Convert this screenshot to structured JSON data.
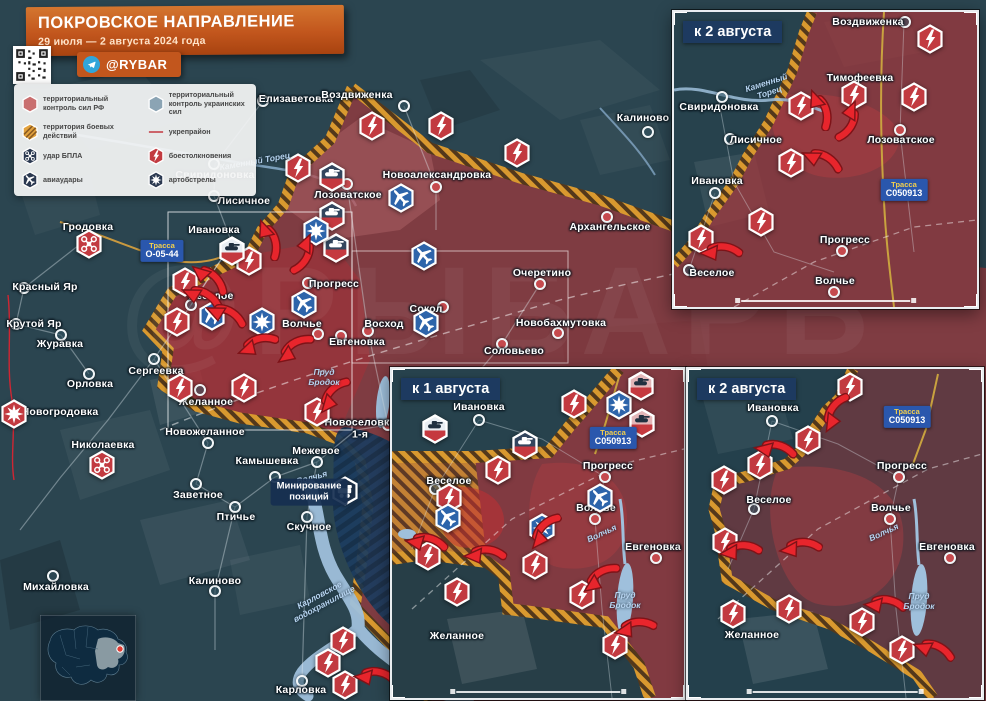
{
  "header": {
    "title": "ПОКРОВСКОЕ НАПРАВЛЕНИЕ",
    "date_range": "29 июля — 2 августа 2024 года",
    "channel": "@RYBAR"
  },
  "colors": {
    "rf_control": "#b24a4e",
    "ua_control": "#8ba4b4",
    "combat_zone": "#d9992f",
    "fortified_line": "#c0222c",
    "accent_orange": "#c2561d",
    "inset_header_bg": "#1d3a60",
    "road_label_bg": "#2a57ad",
    "water": "#9fc0dc"
  },
  "legend": {
    "items": [
      {
        "icon": "rf-control",
        "label": "территориальный контроль сил РФ"
      },
      {
        "icon": "ua-control",
        "label": "территориальный контроль украинских сил"
      },
      {
        "icon": "combat-zone",
        "label": "территория боевых действий"
      },
      {
        "icon": "fortline",
        "label": "укрепрайон"
      },
      {
        "icon": "drone-dark",
        "label": "удар БПЛА"
      },
      {
        "icon": "clash",
        "label": "боестолкновения"
      },
      {
        "icon": "airstrike-dark",
        "label": "авиаудары"
      },
      {
        "icon": "artillery-dark",
        "label": "артобстрелы"
      }
    ]
  },
  "main_map": {
    "towns": [
      [
        "Елизаветовка",
        296,
        100,
        263,
        101,
        "ua"
      ],
      [
        "Воздвиженка",
        357,
        96,
        404,
        106,
        "ua"
      ],
      [
        "Калиново",
        643,
        119,
        648,
        132,
        "ua"
      ],
      [
        "Свиридоновка",
        215,
        176,
        214,
        164,
        "ua"
      ],
      [
        "Лисичное",
        244,
        202,
        214,
        196,
        "ua"
      ],
      [
        "Лозоватское",
        348,
        196,
        347,
        184,
        "rf"
      ],
      [
        "Новоалександровка",
        437,
        176,
        436,
        187,
        "rf"
      ],
      [
        "Архангельское",
        610,
        228,
        607,
        217,
        "rf"
      ],
      [
        "Ивановка",
        214,
        231,
        232,
        243,
        "ua"
      ],
      [
        "Очеретино",
        542,
        274,
        540,
        284,
        "rf"
      ],
      [
        "Веселое",
        211,
        297,
        191,
        305,
        "ua"
      ],
      [
        "Прогресс",
        334,
        285,
        308,
        283,
        "rf"
      ],
      [
        "Волчье",
        302,
        325,
        318,
        334,
        "rf"
      ],
      [
        "Восход",
        384,
        325,
        368,
        331,
        "rf"
      ],
      [
        "Сокол",
        426,
        310,
        443,
        307,
        "rf"
      ],
      [
        "Евгеновка",
        357,
        343,
        341,
        336,
        "rf"
      ],
      [
        "Новобахмутовка",
        561,
        324,
        558,
        333,
        "rf"
      ],
      [
        "Соловьево",
        514,
        352,
        502,
        344,
        "rf"
      ],
      [
        "Сергеевка",
        156,
        372,
        154,
        359,
        "ua"
      ],
      [
        "Желанное",
        206,
        403,
        200,
        390,
        "ua"
      ],
      [
        "Новоселовка\n1-я",
        360,
        429,
        388,
        425,
        "rf"
      ],
      [
        "Гродовка",
        88,
        228,
        null,
        null,
        "ua"
      ],
      [
        "Красный Яр",
        45,
        288,
        24,
        288,
        "ua"
      ],
      [
        "Крутой Яр",
        34,
        325,
        16,
        324,
        "ua"
      ],
      [
        "Журавка",
        60,
        345,
        61,
        335,
        "ua"
      ],
      [
        "Орловка",
        90,
        385,
        89,
        374,
        "ua"
      ],
      [
        "Новогродовка",
        60,
        413,
        null,
        null,
        "ua"
      ],
      [
        "Николаевка",
        103,
        446,
        null,
        null,
        "ua"
      ],
      [
        "Новожеланное",
        205,
        433,
        208,
        443,
        "ua"
      ],
      [
        "Камышевка",
        267,
        462,
        275,
        477,
        "ua"
      ],
      [
        "Межевое",
        316,
        452,
        317,
        462,
        "ua"
      ],
      [
        "Заветное",
        198,
        496,
        196,
        484,
        "ua"
      ],
      [
        "Птичье",
        236,
        518,
        235,
        507,
        "ua"
      ],
      [
        "Скучное",
        309,
        528,
        307,
        517,
        "ua"
      ],
      [
        "Калиново",
        215,
        582,
        215,
        591,
        "ua"
      ],
      [
        "Михайловка",
        56,
        588,
        53,
        576,
        "ua"
      ],
      [
        "Карловка",
        301,
        691,
        302,
        681,
        "ua"
      ]
    ],
    "icons": [
      [
        "clash",
        372,
        126
      ],
      [
        "clash",
        441,
        126
      ],
      [
        "clash",
        517,
        153
      ],
      [
        "clash",
        298,
        168
      ],
      [
        "clash",
        249,
        261
      ],
      [
        "clash",
        185,
        282
      ],
      [
        "clash",
        177,
        322
      ],
      [
        "clash",
        180,
        388
      ],
      [
        "clash",
        244,
        388
      ],
      [
        "clash",
        317,
        412
      ],
      [
        "clash",
        343,
        641
      ],
      [
        "clash",
        328,
        663
      ],
      [
        "clash",
        345,
        685
      ],
      [
        "tank-dark",
        332,
        177
      ],
      [
        "tank-dark",
        332,
        216
      ],
      [
        "tank-dark",
        336,
        248
      ],
      [
        "tank-white",
        232,
        251
      ],
      [
        "airstrike",
        401,
        198
      ],
      [
        "airstrike",
        424,
        256
      ],
      [
        "airstrike",
        426,
        323
      ],
      [
        "airstrike",
        304,
        304
      ],
      [
        "airstrike",
        212,
        316
      ],
      [
        "artillery-blue",
        316,
        231
      ],
      [
        "artillery-blue",
        262,
        322
      ],
      [
        "drone-red",
        89,
        244
      ],
      [
        "drone-red",
        102,
        465
      ],
      [
        "artillery-red",
        14,
        414
      ],
      [
        "mine",
        345,
        491
      ]
    ],
    "arrows": [
      [
        266,
        240,
        90
      ],
      [
        300,
        252,
        135
      ],
      [
        207,
        281,
        60
      ],
      [
        200,
        300,
        45
      ],
      [
        224,
        318,
        45
      ],
      [
        258,
        348,
        0
      ],
      [
        296,
        352,
        -15
      ],
      [
        336,
        398,
        -30
      ],
      [
        374,
        680,
        25
      ]
    ],
    "road_labels": [
      [
        "Трасса",
        "О-05-44",
        162,
        251
      ]
    ],
    "water_labels": [
      [
        "Каменный Торец",
        255,
        162,
        -10
      ],
      [
        "Пруд\nБродок",
        324,
        378,
        0
      ],
      [
        "Карловское\nводохранилище",
        322,
        600,
        -28
      ],
      [
        "Волчья",
        312,
        478,
        -15
      ]
    ],
    "notes": [
      {
        "text": "Минирование\nпозиций",
        "x": 309,
        "y": 492
      }
    ]
  },
  "insets": [
    {
      "label": "к 2 августа",
      "towns": [
        [
          "Воздвиженка",
          194,
          11,
          231,
          10,
          "ua"
        ],
        [
          "Тимофеевка",
          186,
          67,
          null,
          null,
          "rf"
        ],
        [
          "Свиридоновка",
          45,
          96,
          48,
          85,
          "ua"
        ],
        [
          "Лисичное",
          82,
          129,
          56,
          127,
          "ua"
        ],
        [
          "Лозоватское",
          227,
          129,
          226,
          118,
          "rf"
        ],
        [
          "Ивановка",
          43,
          170,
          41,
          181,
          "ua"
        ],
        [
          "Веселое",
          38,
          262,
          15,
          258,
          "ua"
        ],
        [
          "Прогресс",
          171,
          229,
          168,
          239,
          "rf"
        ],
        [
          "Волчье",
          161,
          270,
          160,
          280,
          "rf"
        ]
      ],
      "icons": [
        [
          "clash",
          256,
          27
        ],
        [
          "clash",
          127,
          94
        ],
        [
          "clash",
          180,
          83
        ],
        [
          "clash",
          240,
          85
        ],
        [
          "clash",
          117,
          151
        ],
        [
          "clash",
          87,
          210
        ],
        [
          "clash",
          27,
          227
        ]
      ],
      "arrows": [
        [
          143,
          98,
          90
        ],
        [
          171,
          107,
          135
        ],
        [
          146,
          151,
          45
        ],
        [
          46,
          243,
          20
        ]
      ],
      "road_labels": [
        [
          "Трасса",
          "C050913",
          230,
          178
        ]
      ],
      "water_labels": [
        [
          "Каменный\nТорец",
          94,
          76,
          -18
        ]
      ]
    },
    {
      "label": "к 1 августа",
      "towns": [
        [
          "Ивановка",
          87,
          39,
          87,
          51,
          "ua"
        ],
        [
          "Веселое",
          57,
          113,
          43,
          120,
          "ua"
        ],
        [
          "Прогресс",
          216,
          98,
          213,
          108,
          "rf"
        ],
        [
          "Волчье",
          204,
          140,
          203,
          150,
          "rf"
        ],
        [
          "Желанное",
          65,
          268,
          null,
          null,
          "ua"
        ],
        [
          "Евгеновка",
          261,
          179,
          264,
          189,
          "rf"
        ]
      ],
      "icons": [
        [
          "tank-white",
          43,
          60
        ],
        [
          "tank-dark",
          133,
          76
        ],
        [
          "clash",
          182,
          35
        ],
        [
          "artillery-blue",
          227,
          36
        ],
        [
          "tank-pink",
          249,
          17
        ],
        [
          "tank-pink",
          250,
          54
        ],
        [
          "clash",
          106,
          101
        ],
        [
          "clash",
          57,
          129
        ],
        [
          "airstrike",
          56,
          149
        ],
        [
          "airstrike",
          208,
          129
        ],
        [
          "artillery-blue",
          150,
          159
        ],
        [
          "clash",
          36,
          187
        ],
        [
          "clash",
          65,
          223
        ],
        [
          "clash",
          143,
          196
        ],
        [
          "clash",
          190,
          226
        ],
        [
          "clash",
          223,
          276
        ]
      ],
      "arrows": [
        [
          155,
          165,
          -30
        ],
        [
          92,
          189,
          20
        ],
        [
          210,
          212,
          -15
        ],
        [
          243,
          262,
          10
        ],
        [
          33,
          177,
          30
        ]
      ],
      "road_labels": [
        [
          "Трасса",
          "C050913",
          221,
          69
        ]
      ],
      "water_labels": [
        [
          "Пруд\nБродок",
          233,
          232,
          0
        ],
        [
          "Волчья",
          210,
          165,
          -25
        ]
      ]
    },
    {
      "label": "к 2 августа",
      "towns": [
        [
          "Ивановка",
          85,
          40,
          84,
          52,
          "ua"
        ],
        [
          "Веселое",
          81,
          132,
          66,
          140,
          "ua"
        ],
        [
          "Прогресс",
          214,
          98,
          211,
          108,
          "rf"
        ],
        [
          "Волчье",
          203,
          140,
          202,
          150,
          "rf"
        ],
        [
          "Желанное",
          64,
          267,
          null,
          null,
          "ua"
        ],
        [
          "Евгеновка",
          259,
          179,
          262,
          189,
          "rf"
        ]
      ],
      "icons": [
        [
          "clash",
          162,
          18
        ],
        [
          "clash",
          120,
          71
        ],
        [
          "clash",
          72,
          96
        ],
        [
          "clash",
          36,
          111
        ],
        [
          "clash",
          37,
          173
        ],
        [
          "clash",
          45,
          245
        ],
        [
          "clash",
          101,
          240
        ],
        [
          "clash",
          174,
          253
        ],
        [
          "clash",
          214,
          281
        ]
      ],
      "arrows": [
        [
          150,
          46,
          -40
        ],
        [
          86,
          84,
          30
        ],
        [
          52,
          185,
          15
        ],
        [
          112,
          182,
          15
        ],
        [
          196,
          239,
          25
        ],
        [
          244,
          284,
          40
        ]
      ],
      "road_labels": [
        [
          "Трасса",
          "C050913",
          219,
          48
        ]
      ],
      "water_labels": [
        [
          "Пруд\nБродок",
          231,
          233,
          0
        ],
        [
          "Волчья",
          196,
          164,
          -25
        ]
      ]
    }
  ],
  "minimap": {
    "marker": {
      "x": 80,
      "y": 34
    }
  },
  "watermark": "@РЫБАРЬ"
}
